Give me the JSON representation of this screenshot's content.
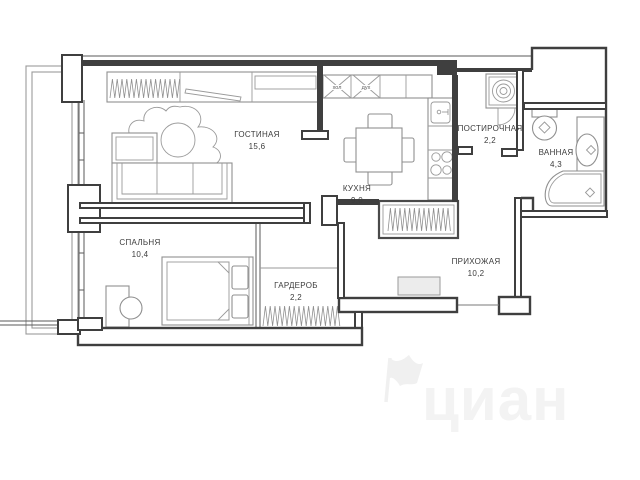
{
  "floorplan": {
    "watermark_text": "циан",
    "rooms": [
      {
        "name": "ГОСТИНАЯ",
        "area": "15,6"
      },
      {
        "name": "КУХНЯ",
        "area": "9,0"
      },
      {
        "name": "ПОСТИРОЧНАЯ",
        "area": "2,2"
      },
      {
        "name": "ВАННАЯ",
        "area": "4,3"
      },
      {
        "name": "СПАЛЬНЯ",
        "area": "10,4"
      },
      {
        "name": "ГАРДЕРОБ",
        "area": "2,2"
      },
      {
        "name": "ПРИХОЖАЯ",
        "area": "10,2"
      }
    ],
    "appliances": {
      "fridge_label": "хол",
      "oven_label": "дух"
    },
    "colors": {
      "walls": "#3f3f3f",
      "furniture": "#8f8f8f",
      "text": "#3c3c3c",
      "watermark": "#f3f3f3"
    }
  }
}
